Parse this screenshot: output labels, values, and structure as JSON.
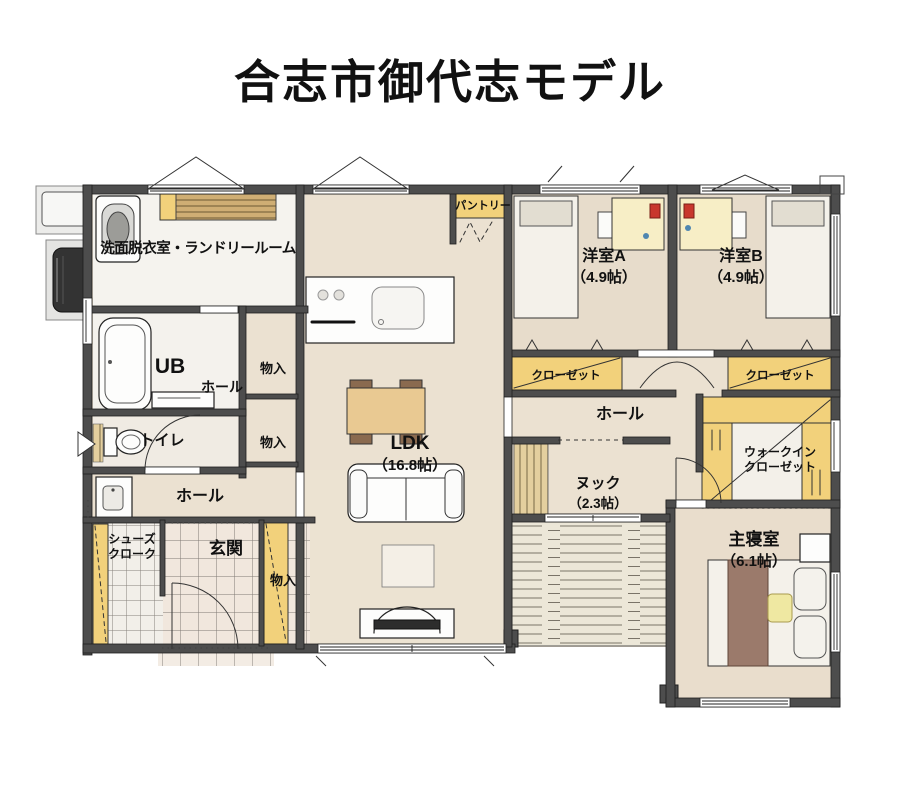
{
  "title": "合志市御代志モデル",
  "rooms": {
    "laundry": {
      "label": "洗面脱衣室・ランドリールーム"
    },
    "bath": {
      "label": "UB"
    },
    "hall_upper": {
      "label": "ホール"
    },
    "storage_upper": {
      "label": "物入"
    },
    "storage_mid": {
      "label": "物入"
    },
    "toilet": {
      "label": "トイレ"
    },
    "hall_lower": {
      "label": "ホール"
    },
    "shoe_cloak": {
      "line1": "シューズ",
      "line2": "クローク"
    },
    "entrance": {
      "label": "玄関"
    },
    "storage_entrance": {
      "label": "物入"
    },
    "pantry": {
      "label": "パントリー"
    },
    "ldk": {
      "label": "LDK",
      "size": "（16.8帖）"
    },
    "bedroom_a": {
      "label": "洋室A",
      "size": "（4.9帖）"
    },
    "bedroom_b": {
      "label": "洋室B",
      "size": "（4.9帖）"
    },
    "closet_a": {
      "label": "クローゼット"
    },
    "closet_b": {
      "label": "クローゼット"
    },
    "hall_center": {
      "label": "ホール"
    },
    "walk_in_closet": {
      "line1": "ウォークイン",
      "line2": "クローゼット"
    },
    "nook": {
      "label": "ヌック",
      "size": "（2.3帖）"
    },
    "master_bedroom": {
      "label": "主寝室",
      "size": "（6.1帖）"
    }
  },
  "colors": {
    "wall": "#4d4d4d",
    "floor_wood": "#ebe1d1",
    "room_white": "#f5f3ee",
    "closet_yellow": "#f2d17b",
    "furniture_tan": "#e9c992",
    "deck": "#ece7d8",
    "text": "#111111"
  }
}
